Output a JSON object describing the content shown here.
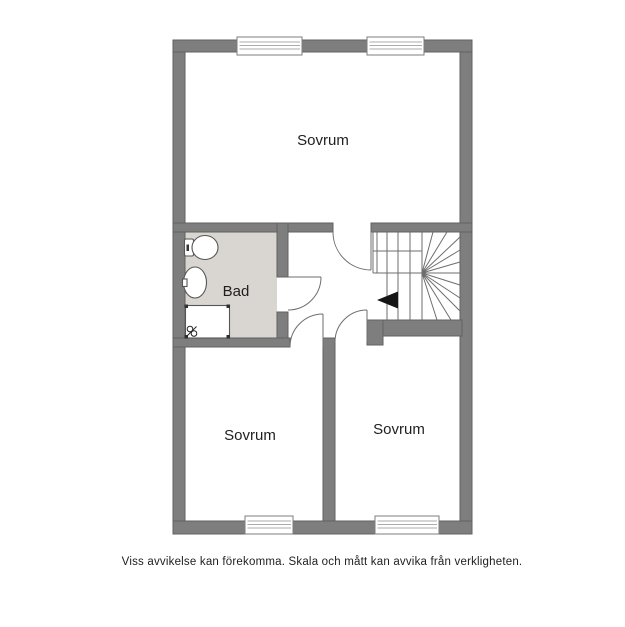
{
  "floorplan": {
    "rooms": {
      "bedroom_top": {
        "label": "Sovrum"
      },
      "bathroom": {
        "label": "Bad"
      },
      "bedroom_bottom_left": {
        "label": "Sovrum"
      },
      "bedroom_bottom_right": {
        "label": "Sovrum"
      }
    },
    "icons": [
      "toilet-icon",
      "sink-icon",
      "shower-icon",
      "stairs-direction-arrow-icon"
    ],
    "colors": {
      "wall": "#7e7e7e",
      "wall_edge": "#616161",
      "bathroom_floor": "#d9d5d0",
      "line": "#6e6e6e",
      "arrow": "#151515",
      "text": "#1f1f1f"
    }
  },
  "caption": "Viss avvikelse kan förekomma. Skala och mått kan avvika från verkligheten."
}
